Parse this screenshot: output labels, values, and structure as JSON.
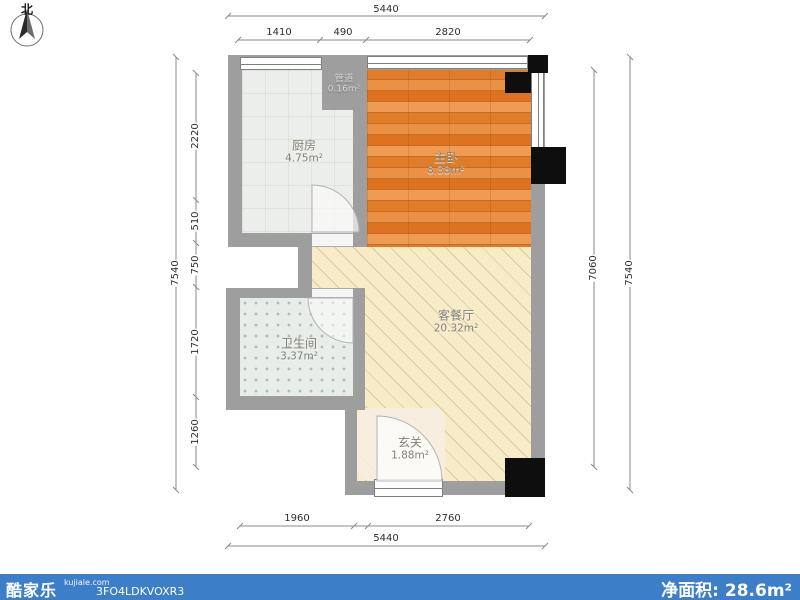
{
  "compass": {
    "north_label": "北"
  },
  "rooms": {
    "duct": {
      "name": "管道",
      "area": "0.16m²"
    },
    "kitchen": {
      "name": "厨房",
      "area": "4.75m²"
    },
    "bedroom": {
      "name": "主卧",
      "area": "8.38m²"
    },
    "living": {
      "name": "客餐厅",
      "area": "20.32m²"
    },
    "bath": {
      "name": "卫生间",
      "area": "3.37m²"
    },
    "entry": {
      "name": "玄关",
      "area": "1.88m²"
    }
  },
  "dimensions": {
    "top_outer": "5440",
    "top_inner": [
      "1410",
      "490",
      "2820"
    ],
    "left_outer": "7540",
    "left_inner": [
      "2220",
      "510",
      "750",
      "1720",
      "1260"
    ],
    "right_inner": "7060",
    "right_outer": "7540",
    "bottom_inner": [
      "1960",
      "2760"
    ],
    "bottom_outer": "5440"
  },
  "footer": {
    "brand": "酷家乐",
    "site": "kujiale.com",
    "plan_code": "3FO4LDKVOXR3",
    "net_area_label": "净面积:",
    "net_area_value": "28.6m²",
    "bar_color": "#3d7ec9"
  },
  "colors": {
    "wall": "#9e9e9e",
    "column": "#0e0e0e",
    "kitchen_floor": "#eceeec",
    "bedroom_floor": "#e58735",
    "living_floor": "#f8ebc8",
    "bath_floor": "#e8edea",
    "entry_floor": "#f6eee2",
    "dim_text": "#2e2e2e"
  }
}
